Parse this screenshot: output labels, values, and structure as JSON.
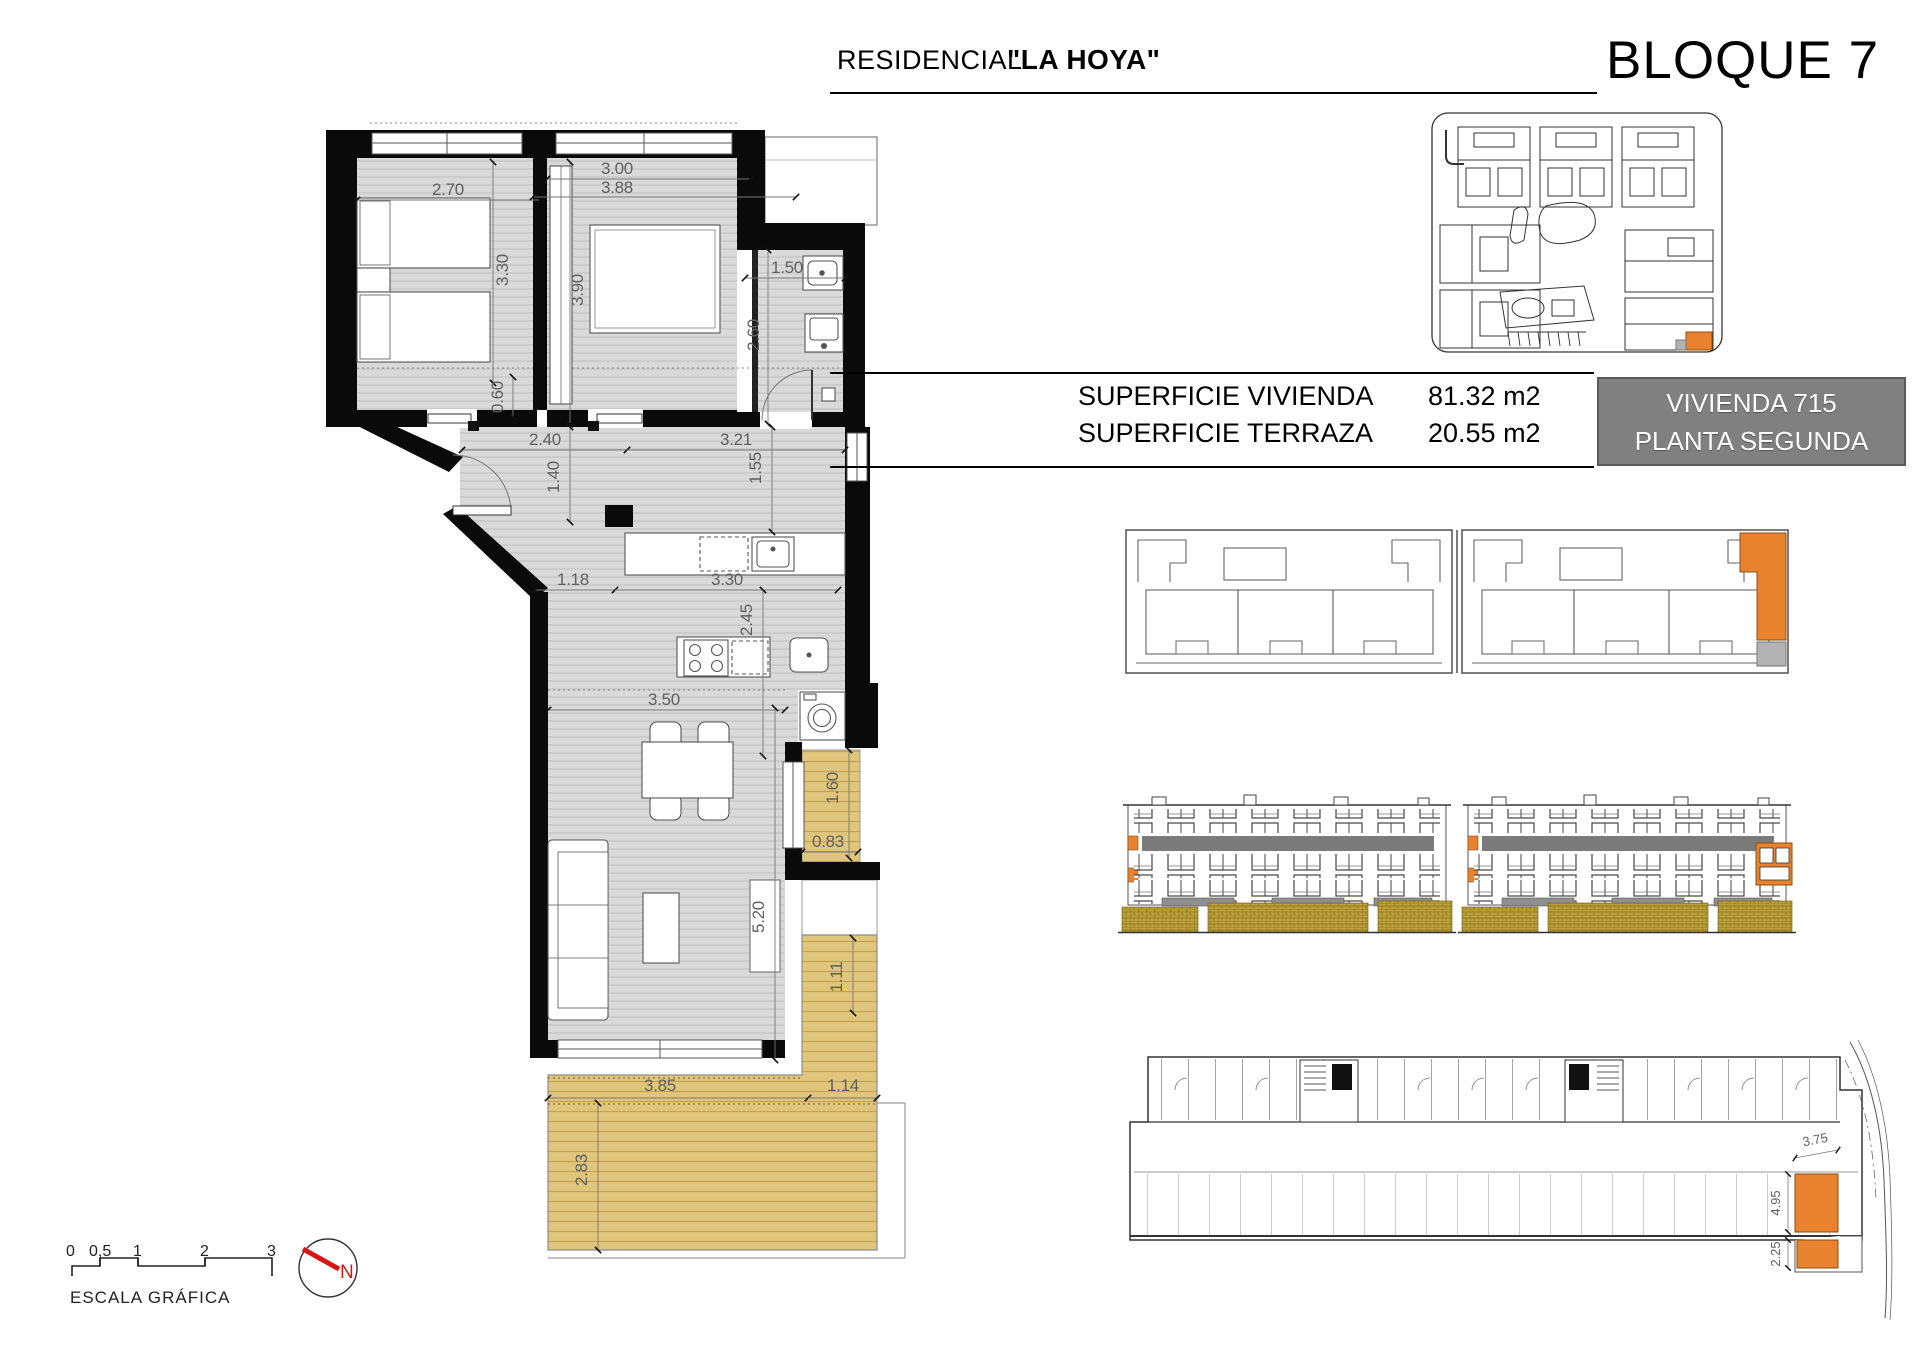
{
  "header": {
    "residencial": "RESIDENCIAL",
    "project": "\"LA HOYA\"",
    "bloque": "BLOQUE 7"
  },
  "info": {
    "rows": [
      {
        "label": "SUPERFICIE VIVIENDA",
        "value": "81.32 m2"
      },
      {
        "label": "SUPERFICIE TERRAZA",
        "value": "20.55 m2"
      }
    ]
  },
  "unit_box": {
    "line1": "VIVIENDA 715",
    "line2": "PLANTA SEGUNDA"
  },
  "plan_dims": {
    "bed1_w": "2.70",
    "bed1_h": "3.30",
    "bed2_w1": "3.00",
    "bed2_w2": "3.88",
    "bed2_h": "3.90",
    "bath_w": "1.50",
    "bath_h": "2.60",
    "nook": "0.60",
    "hall_w1": "2.40",
    "hall_w2": "3.21",
    "hall_h": "1.40",
    "hall_h2": "1.55",
    "kit_w1": "1.18",
    "kit_w2": "3.30",
    "kit_h": "2.45",
    "liv_w": "3.50",
    "liv_h": "5.20",
    "terr1_h": "1.60",
    "terr1_w": "0.83",
    "terr2_h1": "1.11",
    "terr2_w1": "3.85",
    "terr2_w2": "1.14",
    "terr2_h2": "2.83"
  },
  "garage_dims": {
    "w": "3.75",
    "h1": "4.95",
    "h2": "2.25"
  },
  "scale_bar": {
    "ticks": [
      "0",
      "0,5",
      "1",
      "2",
      "3"
    ],
    "label": "ESCALA GRÁFICA"
  },
  "north_label": "N",
  "colors": {
    "highlight_orange": "#E8822F",
    "terrace_tan": "#E0C67C",
    "floor_gray": "#D9D9D9",
    "unit_box_bg": "#808080",
    "ground_hatch_gold": "#C0A23C"
  }
}
